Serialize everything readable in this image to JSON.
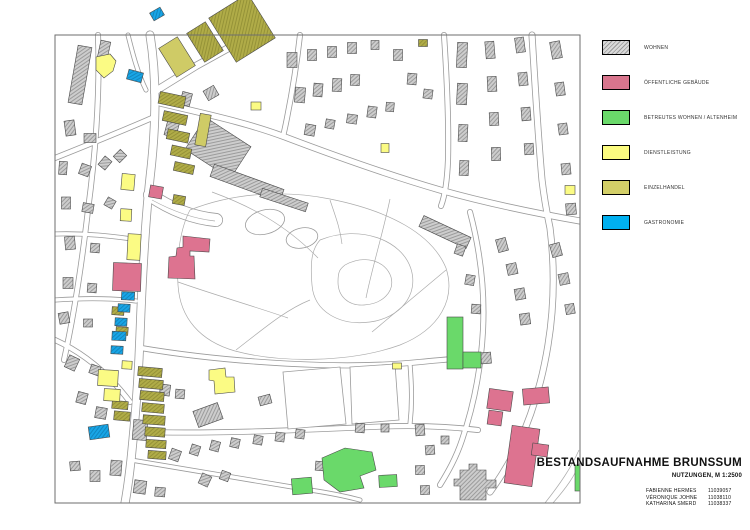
{
  "page": {
    "background": "#ffffff"
  },
  "legend": {
    "items": [
      {
        "label": "WOHNEN",
        "color": "#d9d9d9",
        "hatched": true,
        "hatch_line": "#9a9a9a"
      },
      {
        "label": "ÖFFENTLICHE GEBÄUDE",
        "color": "#d8758d",
        "hatched": false
      },
      {
        "label": "BETREUTES WOHNEN / ALTENHEIM",
        "color": "#6ad96a",
        "hatched": false
      },
      {
        "label": "DIENSTLEISTUNG",
        "color": "#fbfb80",
        "hatched": false
      },
      {
        "label": "EINZELHANDEL",
        "color": "#d3cf68",
        "hatched": false
      },
      {
        "label": "GASTRONOMIE",
        "color": "#00b0f0",
        "hatched": false
      }
    ]
  },
  "titleblock": {
    "title": "BESTANDSAUFNAHME BRUNSSUM",
    "subtitle": "NUTZUNGEN, M 1:2500",
    "credits": [
      {
        "name": "FABIENNE HERMES",
        "id": "11039057"
      },
      {
        "name": "VÉRONIQUE JOHNE",
        "id": "11038110"
      },
      {
        "name": "KATHARINA SMERD",
        "id": "11038337"
      }
    ]
  },
  "map": {
    "frame": {
      "x": 55,
      "y": 35,
      "w": 525,
      "h": 468
    },
    "palette": {
      "line": "#9b9b9b",
      "path": "#ababab",
      "outline": "#4a4a4a",
      "frame": "#6e6e6e",
      "cat": {
        "w": {
          "fill": "#cdcdcd",
          "hatch": true,
          "hatch_line": "#8f8f8f"
        },
        "p": {
          "fill": "#dd7390",
          "hatch": false
        },
        "g": {
          "fill": "#6ad96a",
          "hatch": false
        },
        "y": {
          "fill": "#fbfb84",
          "hatch": false
        },
        "e": {
          "fill": "#b0ac48",
          "hatch": true,
          "hatch_line": "#8e8b33"
        },
        "eh": {
          "fill": "#cfcb66",
          "hatch": false
        },
        "b": {
          "fill": "#18a5e6",
          "hatch": true,
          "hatch_line": "#0f7fb5"
        }
      }
    },
    "roads": [
      {
        "d": "M150,35 C158,85 155,135 150,178 C145,225 142,280 140,335 C138,390 134,430 131,460 C129,478 127,492 125,503",
        "w": 9
      },
      {
        "d": "M154,92 L196,66 L252,35",
        "w": 8
      },
      {
        "d": "M152,118 C120,132 85,146 55,158",
        "w": 6
      },
      {
        "d": "M98,35 C100,90 96,150 88,210 C82,262 74,315 64,360",
        "w": 6
      },
      {
        "d": "M55,234 C85,233 112,236 139,240",
        "w": 5
      },
      {
        "d": "M55,300 C85,298 110,298 136,301",
        "w": 5
      },
      {
        "d": "M55,340 C88,355 112,378 130,402",
        "w": 6
      },
      {
        "d": "M128,35 C133,55 138,74 146,90",
        "w": 5
      },
      {
        "d": "M160,103 C205,114 245,122 285,137 C335,156 385,174 440,190 C490,204 540,214 580,221",
        "w": 7
      },
      {
        "d": "M300,35 C297,62 293,88 287,118 C285,128 284,133 283,136",
        "w": 6
      },
      {
        "d": "M444,35 C447,80 449,122 448,160 C447,186 444,198 441,206",
        "w": 6
      },
      {
        "d": "M532,35 C535,85 538,135 542,180 C545,205 548,218 550,228 C555,268 554,308 548,345 C542,382 532,415 518,445 C510,462 500,478 490,492",
        "w": 7
      },
      {
        "d": "M470,212 C480,250 485,290 483,330 C481,368 474,405 462,440 C456,458 448,472 440,485",
        "w": 6
      },
      {
        "d": "M141,348 C200,358 260,363 320,365 C355,366 390,365 420,362 C440,360 456,359 470,357",
        "w": 6
      },
      {
        "d": "M140,432 C220,434 300,430 370,427 C410,425 445,426 478,430",
        "w": 6
      },
      {
        "d": "M131,460 C190,470 250,480 310,490 C330,493 345,496 360,500",
        "w": 5
      },
      {
        "d": "M410,364 C412,390 412,406 410,424",
        "w": 5
      },
      {
        "d": "M150,195 C172,210 195,218 216,220",
        "w": 14
      }
    ],
    "park_paths": [
      "M190,210 C230,194 280,189 330,199 C390,211 432,234 446,268 C456,299 440,329 400,345 C350,363 280,363 235,351 C200,341 180,318 178,285 C176,255 181,227 190,210",
      "M320,240 C360,224 402,240 411,269 C419,295 400,318 370,322 C340,326 314,312 312,285 C310,261 312,249 320,240",
      "M345,265 C365,254 386,261 391,277 C395,292 382,304 364,305 C348,306 338,296 338,282 C338,271 340,269 345,265",
      "M212,192 C250,206 285,224 318,258",
      "M178,282 C215,295 250,305 288,318",
      "M236,350 C262,330 285,310 310,300",
      "M446,270 C420,292 398,310 372,332",
      "M330,200 C336,218 340,228 342,244",
      "M152,200 C176,213 196,219 215,221",
      "M390,199 C382,237 372,268 366,298",
      "M545,503 C560,484 571,468 579,450",
      "M553,503 C566,488 575,476 580,462"
    ],
    "fields": [
      "283,372 340,367 346,424 288,429",
      "350,367 395,364 399,420 352,424"
    ],
    "ellipses": [
      [
        265,
        222,
        20,
        12,
        -15
      ],
      [
        302,
        238,
        16,
        10,
        -12
      ]
    ],
    "rect_buildings": [
      [
        "w",
        80,
        75,
        14,
        58,
        10
      ],
      [
        "w",
        104,
        50,
        10,
        18,
        12
      ],
      [
        "w",
        70,
        128,
        10,
        15,
        -8
      ],
      [
        "w",
        90,
        138,
        12,
        9,
        0
      ],
      [
        "w",
        63,
        168,
        8,
        13,
        4
      ],
      [
        "w",
        85,
        170,
        10,
        11,
        20
      ],
      [
        "w",
        105,
        163,
        9,
        11,
        40
      ],
      [
        "w",
        120,
        156,
        9,
        10,
        45
      ],
      [
        "w",
        66,
        203,
        9,
        12,
        0
      ],
      [
        "w",
        88,
        208,
        11,
        9,
        10
      ],
      [
        "w",
        110,
        203,
        9,
        9,
        30
      ],
      [
        "w",
        70,
        243,
        10,
        13,
        -5
      ],
      [
        "w",
        95,
        248,
        9,
        9,
        5
      ],
      [
        "w",
        68,
        283,
        10,
        11,
        0
      ],
      [
        "w",
        92,
        288,
        9,
        9,
        5
      ],
      [
        "w",
        64,
        318,
        10,
        11,
        -10
      ],
      [
        "w",
        88,
        323,
        9,
        8,
        0
      ],
      [
        "w",
        72,
        363,
        11,
        13,
        25
      ],
      [
        "w",
        95,
        370,
        10,
        9,
        20
      ],
      [
        "w",
        82,
        398,
        10,
        11,
        15
      ],
      [
        "w",
        101,
        413,
        11,
        11,
        10
      ],
      [
        "w",
        75,
        466,
        10,
        9,
        -5
      ],
      [
        "w",
        95,
        476,
        10,
        11,
        0
      ],
      [
        "w",
        116,
        468,
        11,
        15,
        5
      ],
      [
        "w",
        140,
        487,
        12,
        13,
        8
      ],
      [
        "w",
        160,
        492,
        10,
        9,
        5
      ],
      [
        "w",
        218,
        148,
        54,
        38,
        33
      ],
      [
        "w",
        172,
        128,
        12,
        17,
        15
      ],
      [
        "w",
        186,
        99,
        10,
        13,
        15
      ],
      [
        "w",
        211,
        93,
        12,
        11,
        -30
      ],
      [
        "w",
        247,
        183,
        74,
        13,
        20
      ],
      [
        "w",
        284,
        200,
        48,
        9,
        18
      ],
      [
        "w",
        300,
        95,
        10,
        15,
        5
      ],
      [
        "w",
        318,
        90,
        9,
        13,
        5
      ],
      [
        "w",
        337,
        85,
        9,
        13,
        3
      ],
      [
        "w",
        355,
        80,
        9,
        11,
        3
      ],
      [
        "w",
        310,
        130,
        10,
        11,
        10
      ],
      [
        "w",
        330,
        124,
        9,
        9,
        10
      ],
      [
        "w",
        352,
        119,
        10,
        9,
        8
      ],
      [
        "w",
        372,
        112,
        9,
        11,
        8
      ],
      [
        "w",
        390,
        107,
        8,
        9,
        5
      ],
      [
        "w",
        292,
        60,
        10,
        15,
        0
      ],
      [
        "w",
        312,
        55,
        9,
        11,
        0
      ],
      [
        "w",
        332,
        52,
        9,
        11,
        0
      ],
      [
        "w",
        352,
        48,
        9,
        11,
        0
      ],
      [
        "w",
        375,
        45,
        8,
        9,
        0
      ],
      [
        "w",
        398,
        55,
        9,
        11,
        0
      ],
      [
        "w",
        412,
        79,
        9,
        11,
        5
      ],
      [
        "w",
        428,
        94,
        9,
        9,
        8
      ],
      [
        "w",
        462,
        55,
        10,
        25,
        3
      ],
      [
        "w",
        462,
        94,
        10,
        21,
        3
      ],
      [
        "w",
        463,
        133,
        9,
        17,
        3
      ],
      [
        "w",
        464,
        168,
        9,
        15,
        3
      ],
      [
        "w",
        490,
        50,
        9,
        17,
        -5
      ],
      [
        "w",
        492,
        84,
        9,
        15,
        -3
      ],
      [
        "w",
        494,
        119,
        9,
        13,
        -3
      ],
      [
        "w",
        496,
        154,
        9,
        13,
        -2
      ],
      [
        "w",
        520,
        45,
        9,
        15,
        -8
      ],
      [
        "w",
        523,
        79,
        9,
        13,
        -6
      ],
      [
        "w",
        526,
        114,
        9,
        13,
        -5
      ],
      [
        "w",
        529,
        149,
        9,
        11,
        -4
      ],
      [
        "w",
        556,
        50,
        10,
        17,
        -10
      ],
      [
        "w",
        560,
        89,
        9,
        13,
        -8
      ],
      [
        "w",
        563,
        129,
        9,
        11,
        -8
      ],
      [
        "w",
        566,
        169,
        9,
        11,
        -6
      ],
      [
        "w",
        571,
        209,
        10,
        11,
        -5
      ],
      [
        "w",
        445,
        232,
        52,
        12,
        25
      ],
      [
        "w",
        502,
        245,
        10,
        13,
        -15
      ],
      [
        "w",
        512,
        269,
        10,
        11,
        -12
      ],
      [
        "w",
        520,
        294,
        10,
        11,
        -10
      ],
      [
        "w",
        525,
        319,
        10,
        11,
        -8
      ],
      [
        "w",
        556,
        250,
        10,
        13,
        -15
      ],
      [
        "w",
        564,
        279,
        10,
        11,
        -12
      ],
      [
        "w",
        570,
        309,
        9,
        10,
        -10
      ],
      [
        "w",
        486,
        358,
        10,
        11,
        -5
      ],
      [
        "w",
        460,
        250,
        9,
        10,
        20
      ],
      [
        "w",
        470,
        280,
        9,
        10,
        10
      ],
      [
        "w",
        476,
        309,
        9,
        9,
        5
      ],
      [
        "w",
        175,
        455,
        10,
        11,
        20
      ],
      [
        "w",
        195,
        450,
        9,
        10,
        18
      ],
      [
        "w",
        215,
        446,
        9,
        10,
        15
      ],
      [
        "w",
        235,
        443,
        9,
        9,
        12
      ],
      [
        "w",
        258,
        440,
        9,
        9,
        10
      ],
      [
        "w",
        280,
        437,
        9,
        9,
        8
      ],
      [
        "w",
        300,
        434,
        9,
        9,
        8
      ],
      [
        "w",
        320,
        466,
        9,
        9,
        5
      ],
      [
        "w",
        420,
        430,
        9,
        11,
        -5
      ],
      [
        "w",
        430,
        450,
        9,
        9,
        -5
      ],
      [
        "w",
        420,
        470,
        9,
        9,
        -3
      ],
      [
        "w",
        425,
        490,
        9,
        9,
        -3
      ],
      [
        "w",
        445,
        440,
        8,
        8,
        0
      ],
      [
        "w",
        205,
        480,
        10,
        11,
        25
      ],
      [
        "w",
        225,
        476,
        9,
        9,
        20
      ],
      [
        "w",
        360,
        428,
        9,
        9,
        5
      ],
      [
        "w",
        385,
        428,
        8,
        8,
        0
      ],
      [
        "w",
        140,
        430,
        14,
        20,
        5
      ],
      [
        "w",
        208,
        415,
        26,
        17,
        -20
      ],
      [
        "w",
        265,
        400,
        12,
        9,
        -15
      ],
      [
        "w",
        165,
        390,
        10,
        11,
        8
      ],
      [
        "w",
        180,
        394,
        9,
        9,
        5
      ],
      [
        "e",
        242,
        28,
        46,
        52,
        -32
      ],
      [
        "e",
        205,
        42,
        22,
        34,
        -32
      ],
      [
        "e",
        172,
        100,
        26,
        12,
        12
      ],
      [
        "e",
        175,
        118,
        24,
        10,
        12
      ],
      [
        "e",
        178,
        136,
        22,
        10,
        12
      ],
      [
        "e",
        181,
        152,
        20,
        10,
        12
      ],
      [
        "e",
        184,
        168,
        20,
        9,
        12
      ],
      [
        "e",
        179,
        200,
        12,
        9,
        10
      ],
      [
        "e",
        150,
        372,
        24,
        9,
        5
      ],
      [
        "e",
        151,
        384,
        24,
        9,
        5
      ],
      [
        "e",
        152,
        396,
        24,
        9,
        5
      ],
      [
        "e",
        153,
        408,
        22,
        9,
        5
      ],
      [
        "e",
        154,
        420,
        22,
        9,
        4
      ],
      [
        "e",
        155,
        432,
        20,
        9,
        4
      ],
      [
        "e",
        156,
        444,
        20,
        8,
        4
      ],
      [
        "e",
        157,
        455,
        18,
        8,
        4
      ],
      [
        "e",
        122,
        416,
        16,
        9,
        5
      ],
      [
        "e",
        120,
        405,
        16,
        8,
        5
      ],
      [
        "e",
        118,
        311,
        12,
        8,
        4
      ],
      [
        "e",
        122,
        331,
        12,
        8,
        4
      ],
      [
        "e",
        423,
        43,
        9,
        7,
        0
      ],
      [
        "eh",
        177,
        57,
        22,
        34,
        -32
      ],
      [
        "eh",
        203,
        130,
        11,
        32,
        10
      ],
      [
        "y",
        128,
        182,
        13,
        16,
        5
      ],
      [
        "y",
        126,
        215,
        11,
        12,
        3
      ],
      [
        "y",
        134,
        247,
        13,
        26,
        3
      ],
      [
        "y",
        108,
        378,
        20,
        16,
        3
      ],
      [
        "y",
        112,
        395,
        16,
        12,
        3
      ],
      [
        "y",
        127,
        365,
        10,
        8,
        3
      ],
      [
        "y",
        256,
        106,
        10,
        8,
        0
      ],
      [
        "y",
        385,
        148,
        8,
        9,
        0
      ],
      [
        "y",
        570,
        190,
        10,
        9,
        0
      ],
      [
        "y",
        397,
        366,
        9,
        6,
        0
      ],
      [
        "b",
        157,
        14,
        12,
        9,
        -30
      ],
      [
        "b",
        135,
        76,
        15,
        10,
        15
      ],
      [
        "b",
        128,
        296,
        13,
        8,
        3
      ],
      [
        "b",
        124,
        308,
        12,
        8,
        3
      ],
      [
        "b",
        121,
        322,
        12,
        8,
        3
      ],
      [
        "b",
        119,
        336,
        14,
        9,
        3
      ],
      [
        "b",
        117,
        350,
        12,
        8,
        3
      ],
      [
        "b",
        130,
        282,
        12,
        8,
        3
      ],
      [
        "b",
        99,
        432,
        20,
        13,
        -8
      ],
      [
        "p",
        156,
        192,
        13,
        12,
        10
      ],
      [
        "p",
        127,
        277,
        28,
        28,
        2
      ],
      [
        "p",
        500,
        400,
        24,
        20,
        8
      ],
      [
        "p",
        495,
        418,
        14,
        14,
        8
      ],
      [
        "p",
        536,
        396,
        26,
        16,
        -5
      ],
      [
        "p",
        522,
        456,
        28,
        58,
        8
      ],
      [
        "p",
        540,
        450,
        16,
        12,
        8
      ],
      [
        "g",
        455,
        343,
        16,
        52,
        0
      ],
      [
        "g",
        472,
        360,
        18,
        16,
        0
      ],
      [
        "g",
        302,
        486,
        20,
        16,
        -5
      ],
      [
        "g",
        388,
        481,
        18,
        12,
        -3
      ],
      [
        "g",
        578,
        478,
        6,
        26,
        0
      ]
    ],
    "poly_buildings": [
      [
        "w",
        "460,500 460,486 454,486 454,479 460,479 460,470 469,470 469,464 477,464 477,470 486,470 486,480 496,480 496,488 486,488 486,500"
      ],
      [
        "y",
        "96,57 110,54 116,61 113,71 104,78 96,70"
      ],
      [
        "y",
        "209,370 225,368 226,377 234,377 235,392 215,394 214,381 209,380"
      ],
      [
        "p",
        "183,236 210,239 209,252 190,251 190,256 194,256 195,279 168,278 169,257 176,256 177,248 183,247"
      ],
      [
        "g",
        "322,458 345,448 372,452 376,470 360,476 364,488 340,492 324,480"
      ]
    ]
  }
}
